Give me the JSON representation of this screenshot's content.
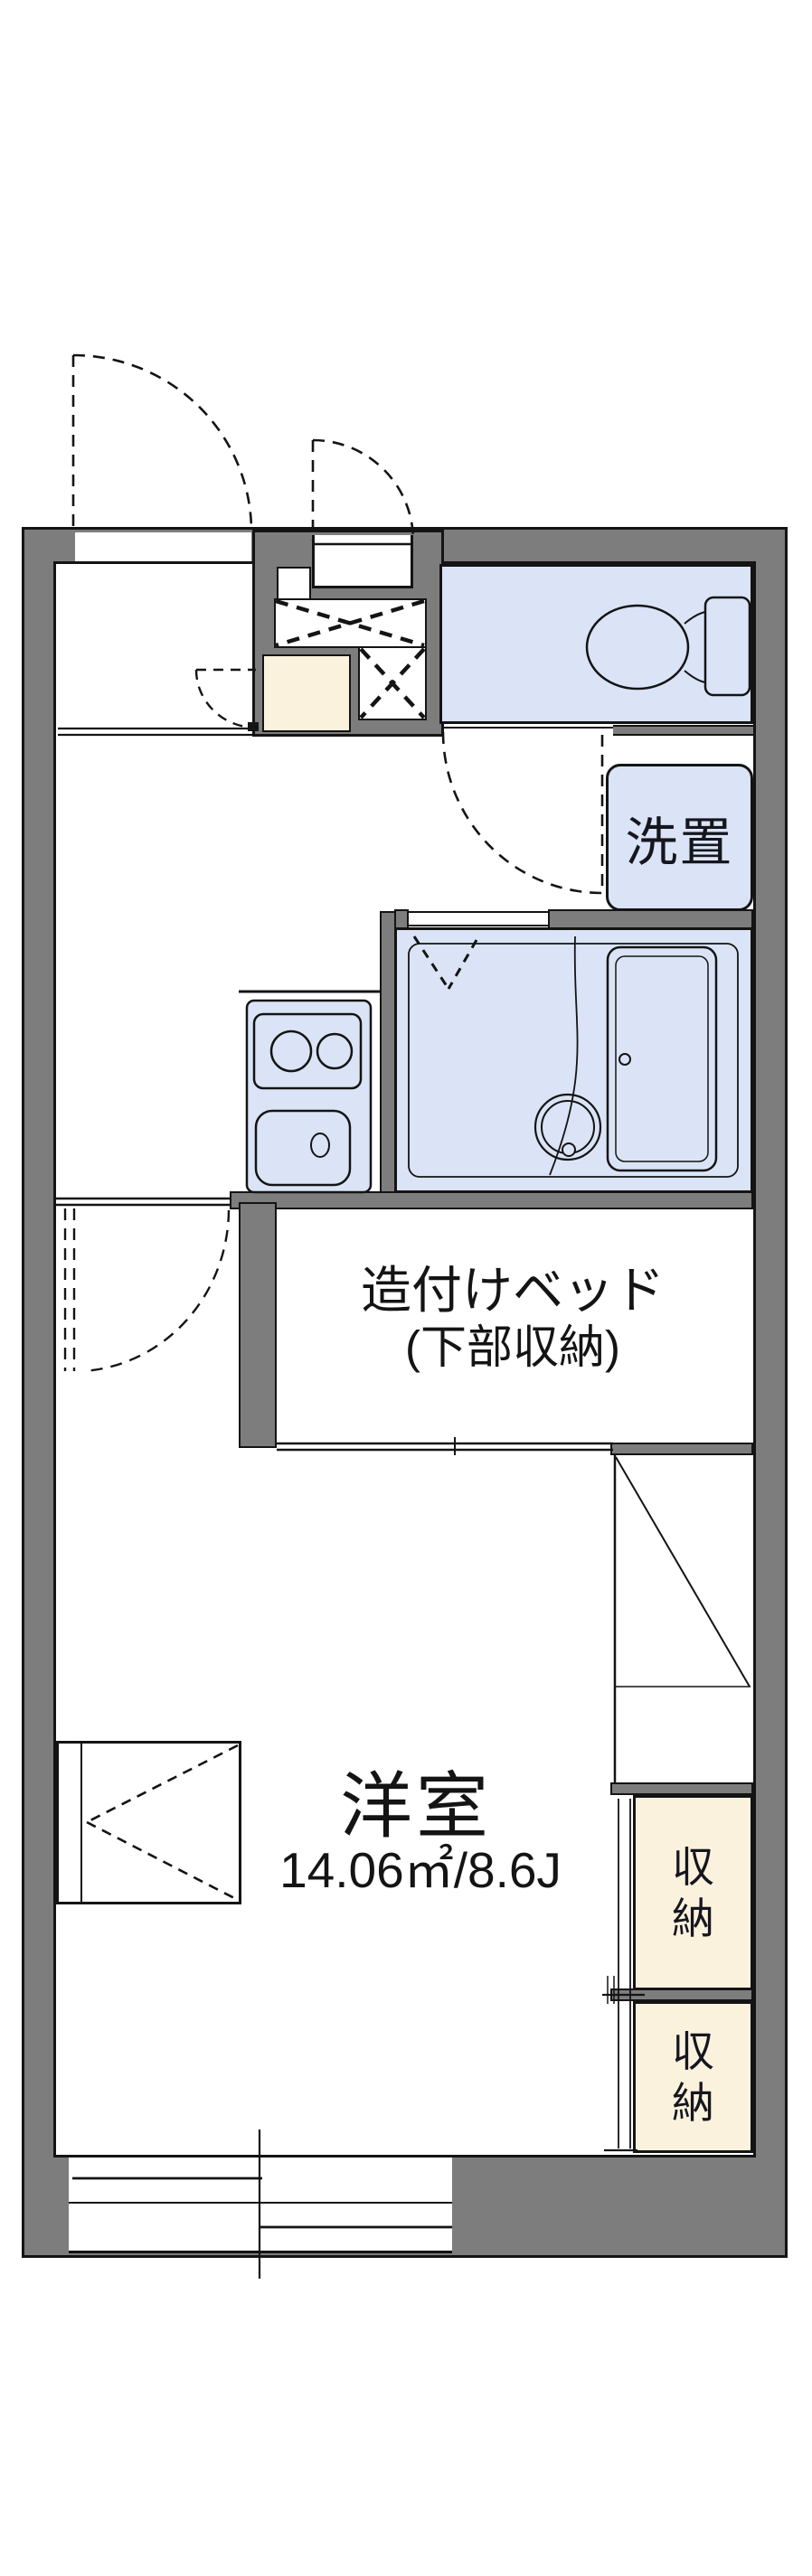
{
  "title": "apartment floor plan",
  "labels": {
    "washer": "洗置",
    "bed_line1": "造付けベッド",
    "bed_line2": "(下部収納)",
    "room_name": "洋室",
    "room_area": "14.06㎡/8.6J",
    "storage_upper": "収納",
    "storage_lower": "収納"
  },
  "rooms": [
    {
      "name": "western-room",
      "label": "洋室",
      "area": "14.06㎡/8.6J"
    },
    {
      "name": "built-in-bed",
      "label": "造付けベッド(下部収納)"
    },
    {
      "name": "washer-place",
      "label": "洗置"
    },
    {
      "name": "storage-upper",
      "label": "収納"
    },
    {
      "name": "storage-lower",
      "label": "収納"
    },
    {
      "name": "toilet",
      "label": ""
    },
    {
      "name": "bathroom",
      "label": ""
    },
    {
      "name": "kitchen",
      "label": ""
    },
    {
      "name": "entrance-genkan",
      "label": ""
    }
  ],
  "fixtures": [
    "toilet-bowl",
    "toilet-tank",
    "bathtub",
    "bath-drain",
    "two-burner-stove",
    "kitchen-sink",
    "sliding-window",
    "entry-door",
    "hinged-doors",
    "built-in-closets"
  ],
  "colors": {
    "wall_gray": "#7d7d7d",
    "water_blue": "#dae4f6",
    "storage_cream": "#fbf2de",
    "line_black": "#141414",
    "background": "#ffffff"
  }
}
